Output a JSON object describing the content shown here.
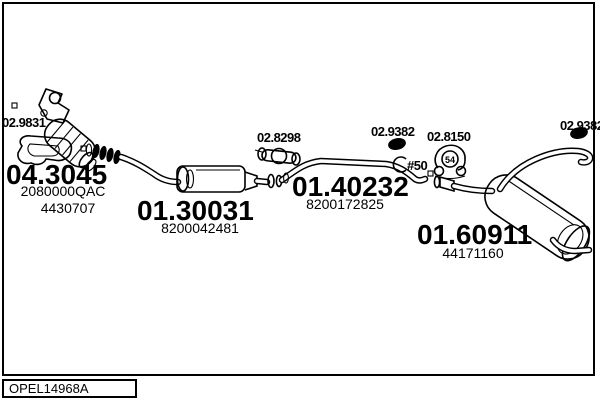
{
  "footer": {
    "drawing_code": "OPEL14968A"
  },
  "colors": {
    "ink": "#000000",
    "background": "#ffffff"
  },
  "parts": {
    "gasket": {
      "code": "02.9831"
    },
    "catalyst": {
      "code": "04.3045",
      "ref1": "2080000QAC",
      "ref2": "4430707"
    },
    "centre_muffler": {
      "code": "01.30031",
      "ref1": "8200042481"
    },
    "clamp_centre": {
      "code": "02.8298"
    },
    "centre_pipe": {
      "code": "01.40232",
      "ref1": "8200172825"
    },
    "clamp_front": {
      "code": "02.9382",
      "size": "52"
    },
    "pipe_diameter": {
      "code": "#50"
    },
    "hanger": {
      "code": "02.8150",
      "size": "54"
    },
    "rear_muffler": {
      "code": "01.60911",
      "ref1": "44171160"
    },
    "clamp_rear": {
      "code": "02.9382",
      "size": "52"
    }
  }
}
